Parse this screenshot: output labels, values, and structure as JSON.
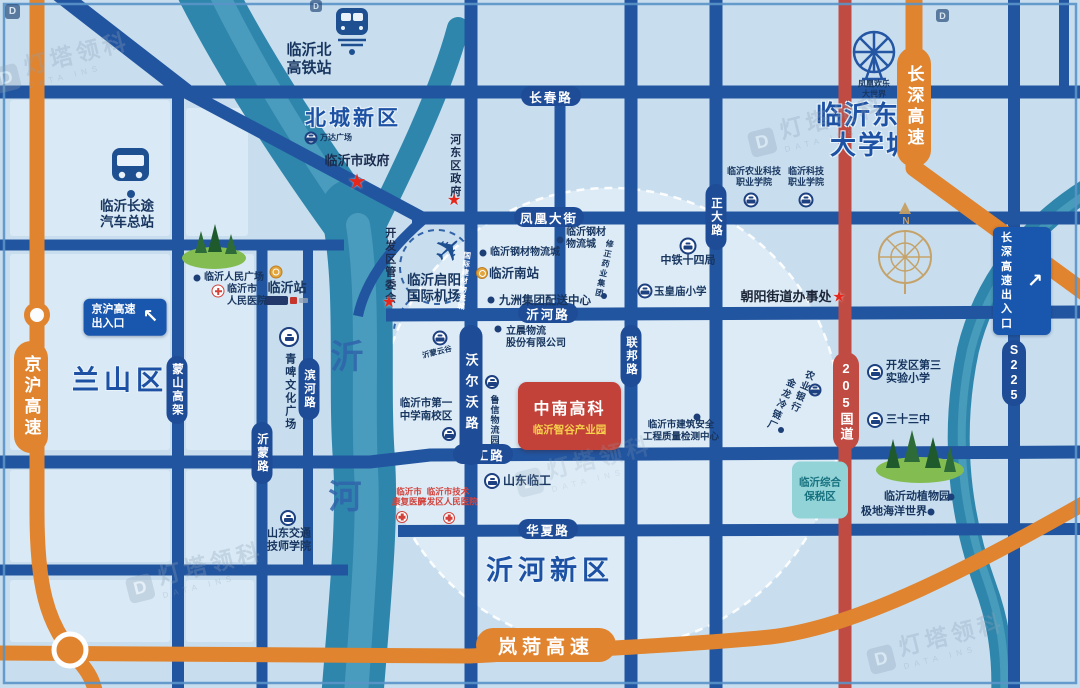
{
  "icons": {
    "plane": "✈",
    "arrow_ne": "↗",
    "arrow_nw": "↖",
    "star": "★",
    "compass_n": "N",
    "logo_letter": "D"
  },
  "watermark": {
    "brand": "灯塔领科",
    "sub": "DATA INS"
  },
  "districts": {
    "beicheng": "北城新区",
    "dongbu": "临沂东部\n大学城",
    "lanshan": "兰山区",
    "yihe_new": "沂河新区"
  },
  "river": {
    "char1": "沂",
    "char2": "河"
  },
  "highways": {
    "jinghu": "京沪高速",
    "changshen": "长深高速",
    "lanhe": "岚菏高速",
    "g205": "205国道",
    "s225": "S225"
  },
  "roads": {
    "changchun": "长春路",
    "fenghuang": "凤凰大街",
    "yihe": "沂河路",
    "lingong": "临工路",
    "huaxia": "华夏路",
    "mengshan": "蒙山高架",
    "yimeng": "沂蒙路",
    "binhe": "滨河路",
    "woerwo": "沃尔沃路",
    "lianbang": "联邦路",
    "zhengda": "正大路",
    "guoji_mart": "国际建材物流城"
  },
  "signs": {
    "jinghu_exit": "京沪高速\n出入口",
    "changshen_exit": "长深高速\n出入口"
  },
  "government": {
    "city_hall": "临沂市政府",
    "hedong": "河东区政府",
    "kaifaqu": "开发区管委会",
    "chaoyang": "朝阳街道办事处"
  },
  "stations": {
    "north_rail": "临沂北\n高铁站",
    "bus_terminal": "临沂长途\n汽车总站",
    "linyi": "临沂站",
    "linyi_south": "临沂南站"
  },
  "center_park": {
    "title": "中南高科",
    "subtitle": "临沂智谷产业园"
  },
  "airport": {
    "name": "临沂启阳\n国际机场"
  },
  "bonded_zone": {
    "name": "临沂综合\n保税区"
  },
  "pois": {
    "wanda": "万达广场",
    "nongye_college": "临沂农业科技\n职业学院",
    "keji_college": "临沂科技\n职业学院",
    "fenghuang_world": "凤凰欢乐\n大世界",
    "zhongtie": "中铁十四局",
    "yuhuangmiao": "玉皇庙小学",
    "gangcai_1": "临沂钢材物流城",
    "gangcai_2": "临沂钢材\n物流城",
    "xiuzheng": "修正药业集团",
    "jiuzhou": "九洲集团配送中心",
    "lichen": "立晨物流\n股份有限公司",
    "renmin_square": "临沂人民广场",
    "renmin_hospital": "临沂市\n人民医院",
    "qingpi": "青啤文化广场",
    "yimeng_cloud": "沂蒙云谷",
    "luxin": "鲁信物流园",
    "yizhong": "临沂市第一\n中学南校区",
    "shandong_lingong": "山东临工",
    "kangfu_hospital": "临沂市\n康复医院",
    "kaifaqu_hospital": "临沂市技术\n开发区人民医院",
    "jiaotong_college": "山东交通\n技师学院",
    "jianzhu_center": "临沂市建筑安全\n工程质量检测中心",
    "nongye_bank": "农业银行",
    "jinlong": "金龙冷链厂",
    "disan_primary": "开发区第三\n实验小学",
    "sanshisan": "三十三中",
    "zoo": "临沂动植物园",
    "ocean_world": "极地海洋世界"
  }
}
